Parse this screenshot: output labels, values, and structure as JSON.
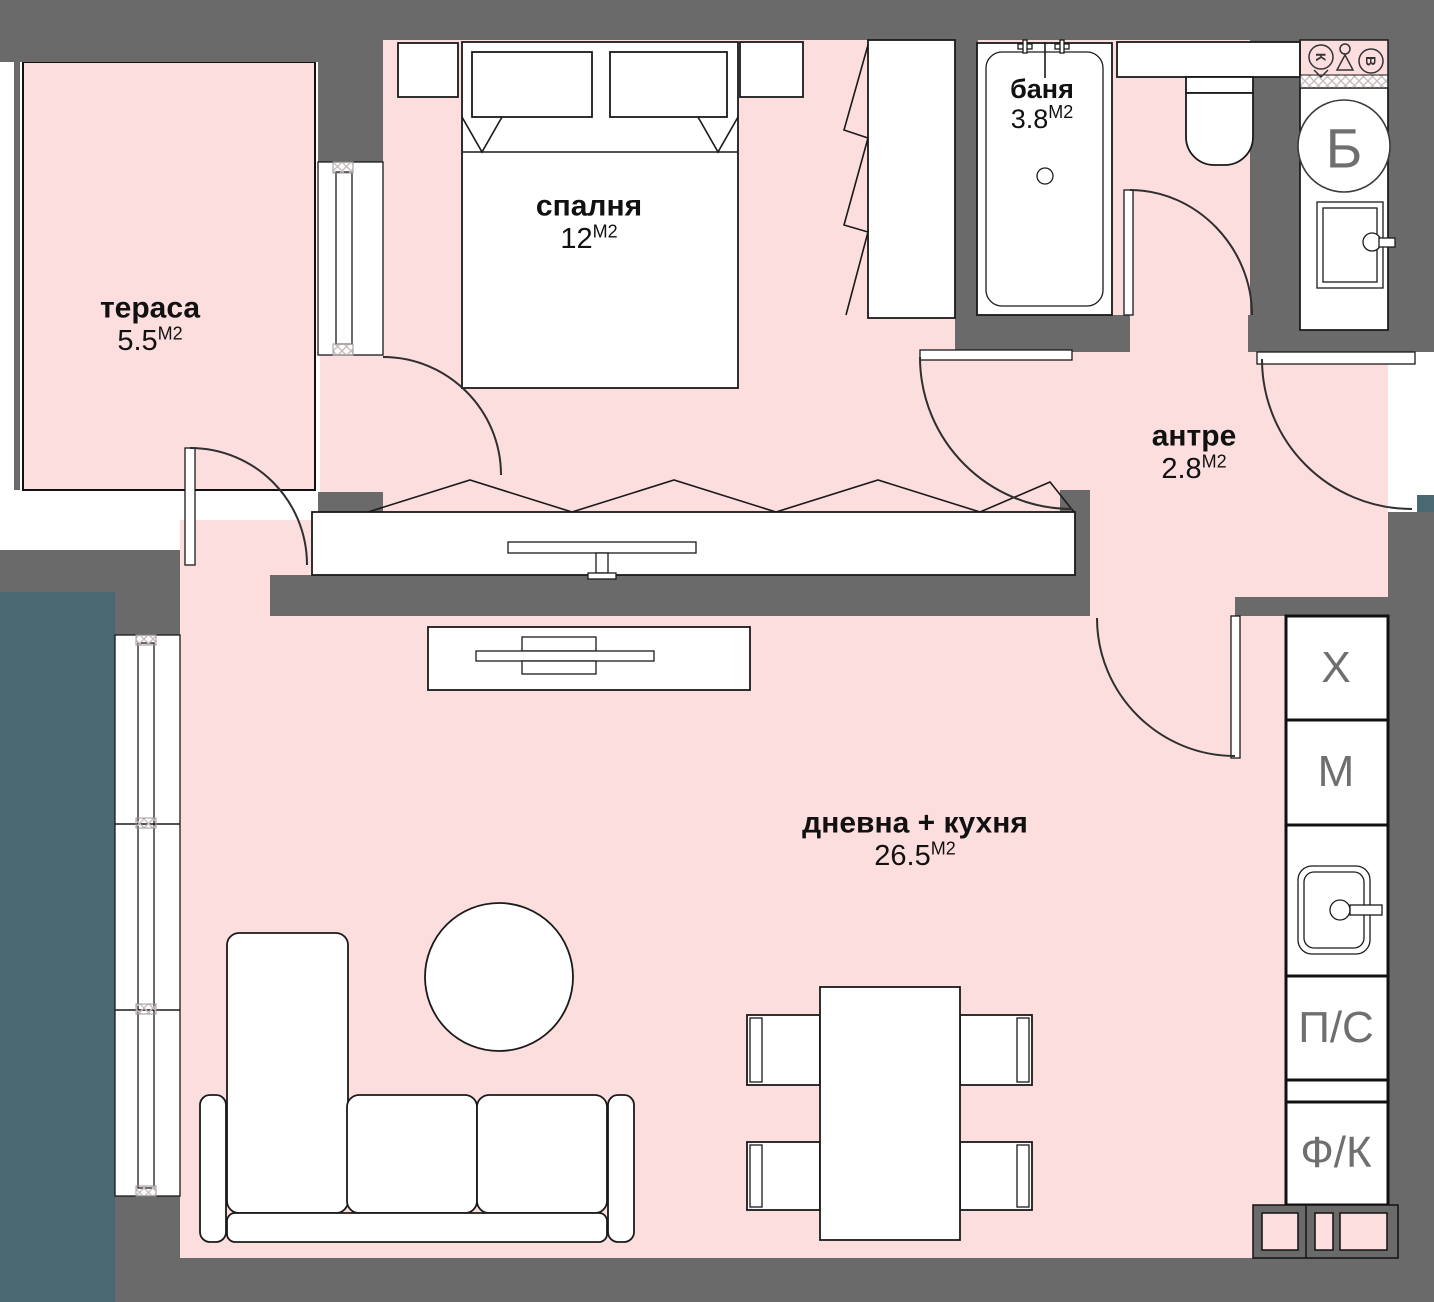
{
  "rooms": [
    {
      "name": "тераса",
      "area": "5.5",
      "unit": "М2"
    },
    {
      "name": "спалня",
      "area": "12",
      "unit": "М2"
    },
    {
      "name": "баня",
      "area": "3.8",
      "unit": "М2"
    },
    {
      "name": "антре",
      "area": "2.8",
      "unit": "М2"
    },
    {
      "name": "дневна + кухня",
      "area": "26.5",
      "unit": "М2"
    }
  ],
  "kitchen_column": {
    "units": [
      "Х",
      "М",
      "П/С",
      "Ф/К"
    ]
  },
  "utility": {
    "boiler": "Б",
    "riser_sewer": "К",
    "riser_water": "В"
  },
  "colors": {
    "wall": "#6a6a6a",
    "floor": "#fcdede",
    "exterior": "#4a6872"
  }
}
